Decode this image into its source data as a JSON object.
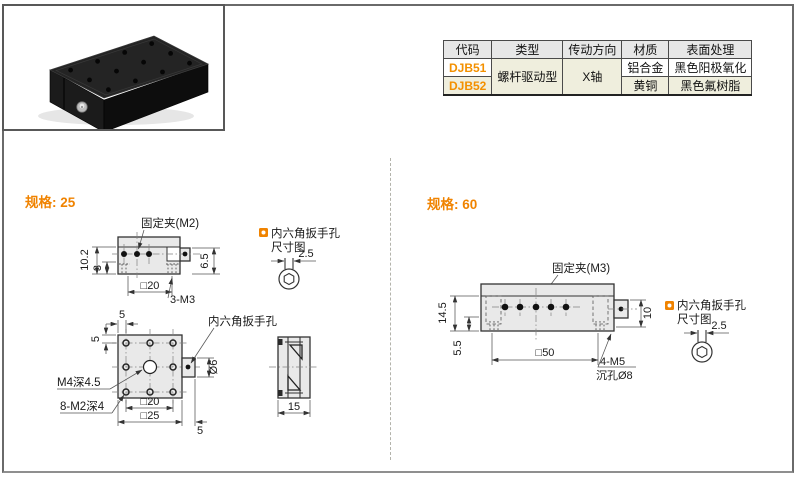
{
  "table": {
    "headers": [
      "代码",
      "类型",
      "传动方向",
      "材质",
      "表面处理"
    ],
    "shared": {
      "type": "螺杆驱动型",
      "direction": "X轴"
    },
    "r1": {
      "code": "DJB51",
      "material": "铝合金",
      "finish": "黑色阳极氧化"
    },
    "r2": {
      "code": "DJB52",
      "material": "黄铜",
      "finish": "黑色氟树脂"
    }
  },
  "spec25": {
    "title": "规格: 25",
    "front": {
      "clamp": "固定夹(M2)",
      "h1": "10.2",
      "h2": "3",
      "w": "□20",
      "holes": "3-M3",
      "k": "6.5"
    },
    "top": {
      "d_top": "5",
      "d_left": "5",
      "wrench": "内六角扳手孔",
      "center": "M4深4.5",
      "holes": "8-M2深4",
      "inner": "□20",
      "outer": "□25",
      "d_right": "5",
      "knob": "Ø6"
    },
    "side": {
      "w": "15"
    },
    "hex": {
      "t1": "内六角扳手孔",
      "t2": "尺寸图",
      "d": "2.5"
    }
  },
  "spec60": {
    "title": "规格: 60",
    "front": {
      "clamp": "固定夹(M3)",
      "h1": "14.5",
      "h2": "5.5",
      "w": "□50",
      "k": "10",
      "holes1": "4-M5",
      "holes2": "沉孔Ø8"
    },
    "hex": {
      "t1": "内六角扳手孔",
      "t2": "尺寸图",
      "d": "2.5"
    }
  },
  "colors": {
    "accent": "#f08300",
    "code_orange": "#f39000",
    "beige": "#efeedd",
    "header_gray": "#e7e7e7",
    "draw_fill": "#e9e9e9"
  }
}
